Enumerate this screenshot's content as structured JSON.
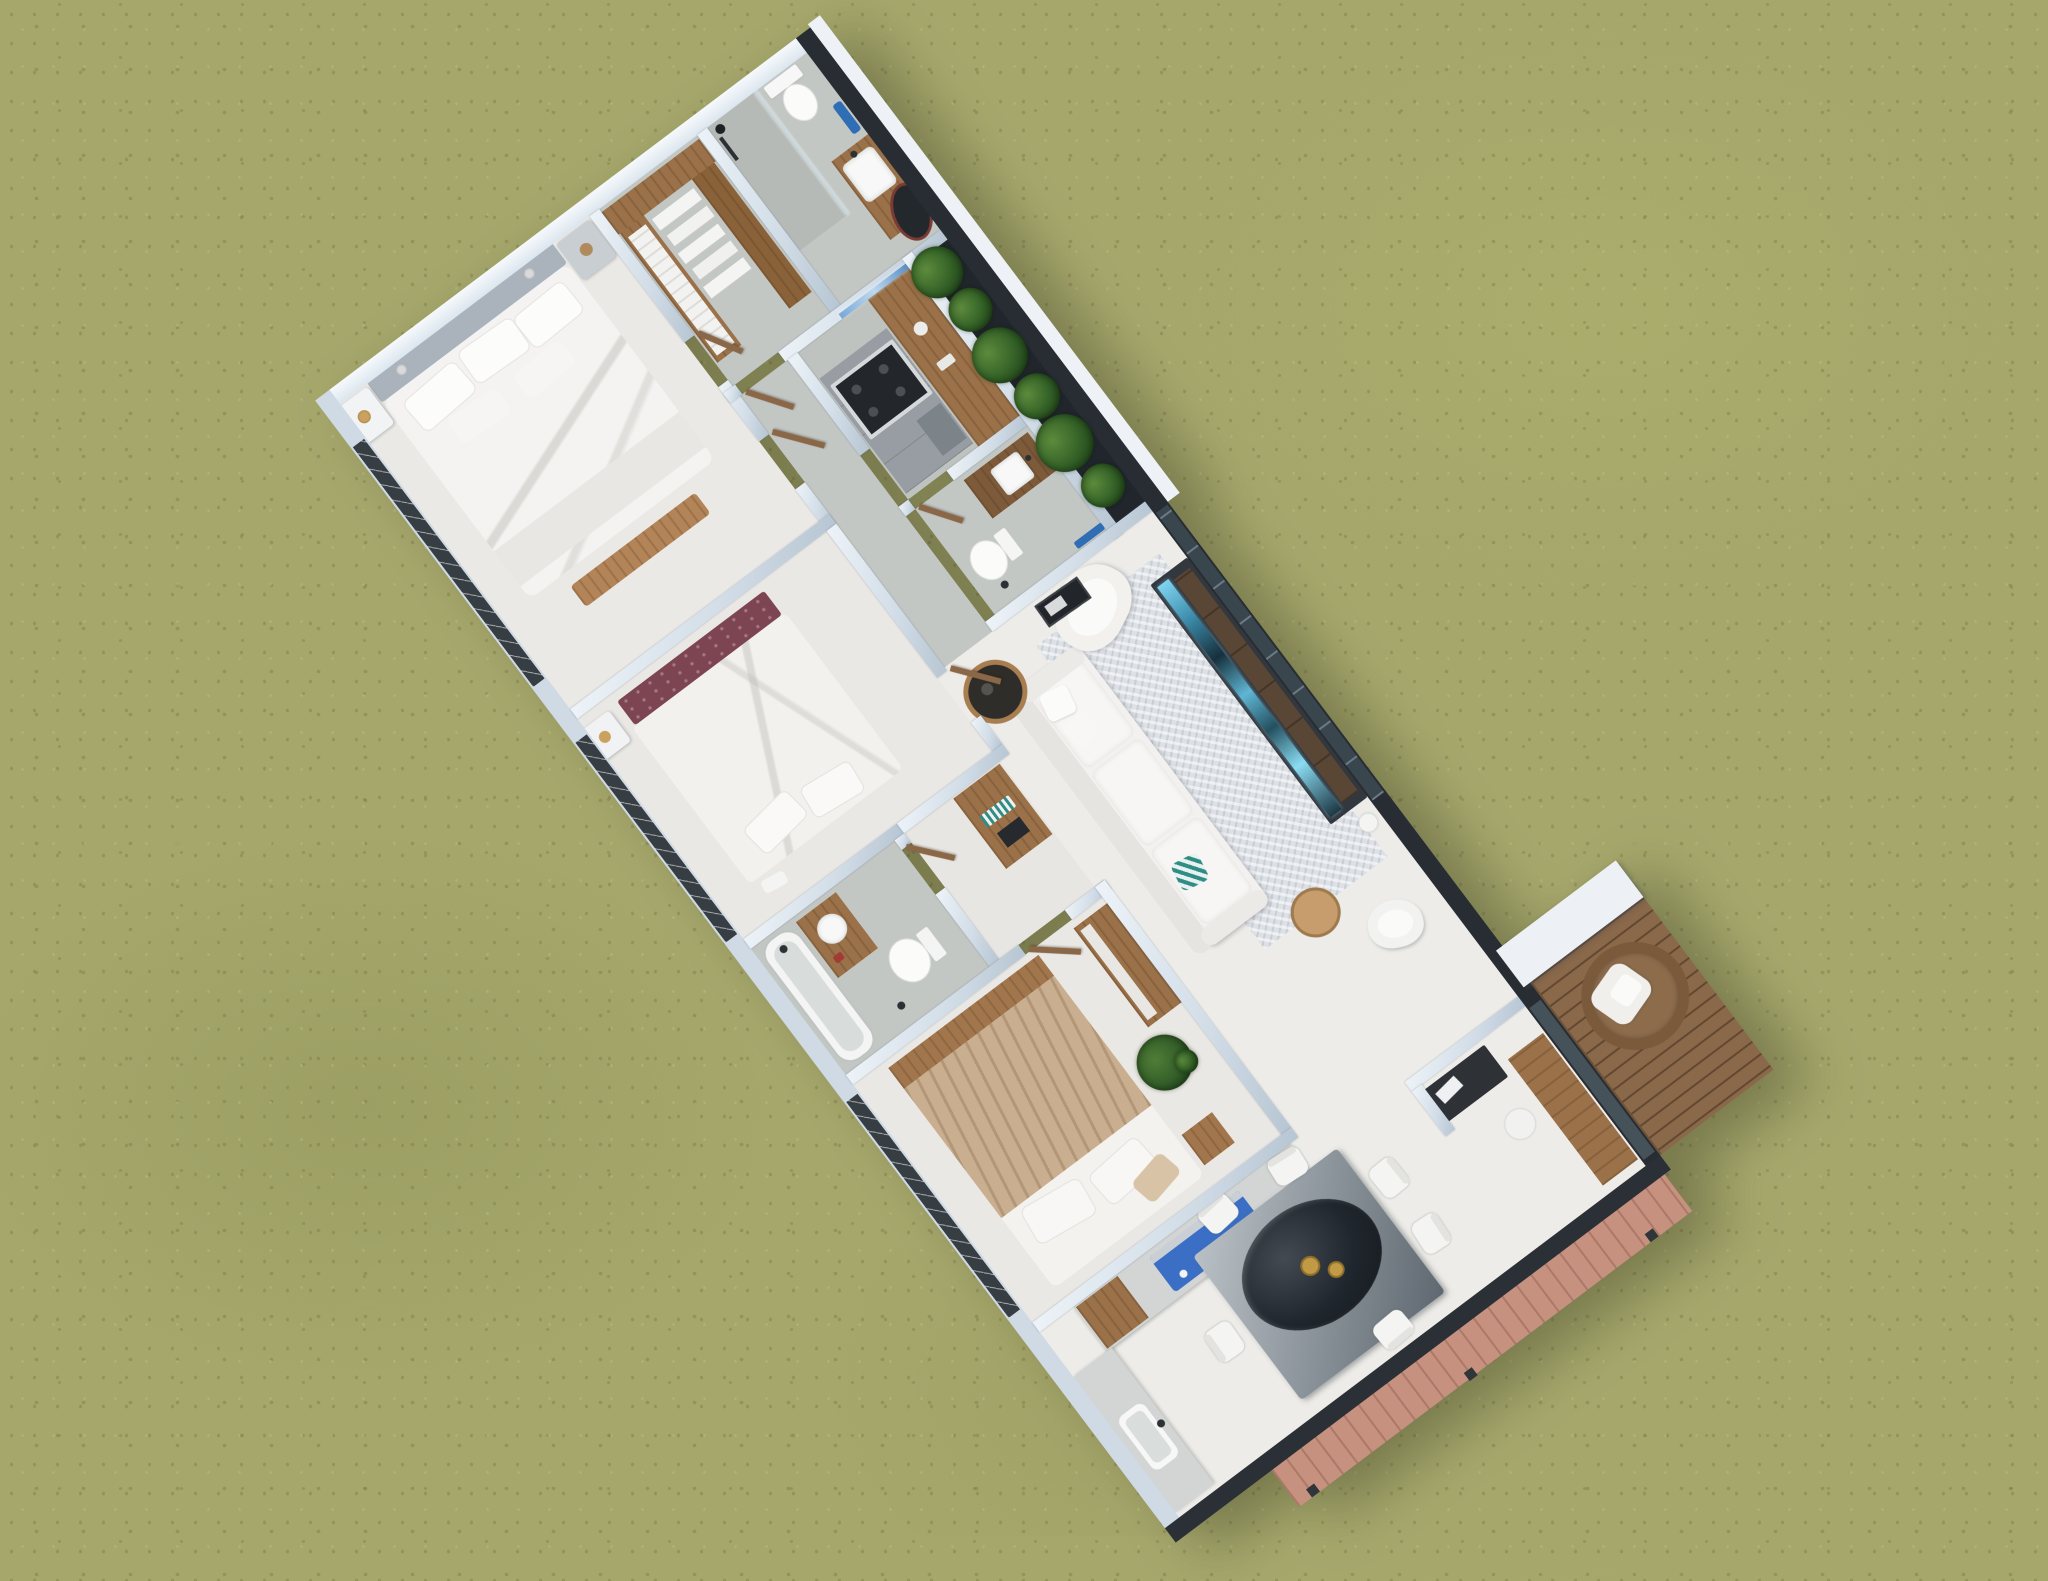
{
  "scene": {
    "type": "3d-floor-plan-aerial-render",
    "view": "top-down dollhouse cutaway of a single-storey house on a grass lawn",
    "house_rotation_deg": -37,
    "no_visible_text": true
  },
  "palette": {
    "grass": "#a5a76b",
    "grass_speckle_dark": "#82854b",
    "grass_speckle_light": "#bdbf7f",
    "wall_top": "#e7eef5",
    "wall_shadow": "#b7c6d3",
    "wall_dark_exterior": "#272d32",
    "floor_white": "#edece8",
    "floor_gray": "#c3c7c4",
    "floor_bedroom": "#eae8e4",
    "wood": "#9a7148",
    "wood_light": "#b28457",
    "maroon_headboard": "#7d4551",
    "tan_blanket": "#c9ae90",
    "cooktop_blue": "#3b6fc6",
    "towel_blue": "#2f6db5",
    "plant_green": "#3c6a2e",
    "deck_wood": "#8a684a",
    "deck_salmon": "#c79180",
    "tv_glow": "#7fd3ef",
    "gold_decor": "#c09a45",
    "white_furniture": "#f2f1ef"
  },
  "rooms": [
    {
      "id": 0,
      "name": "master-bedroom",
      "furniture": [
        "double-bed",
        "two-nightstands",
        "wall-lamps",
        "foot-bench"
      ]
    },
    {
      "id": 1,
      "name": "walk-in-closet",
      "furniture": [
        "l-shaped-wardrobe",
        "folded-clothes-shelves"
      ]
    },
    {
      "id": 2,
      "name": "ensuite-bathroom",
      "furniture": [
        "shower",
        "toilet",
        "vanity-sink",
        "leaning-mirror",
        "blue-towel"
      ]
    },
    {
      "id": 3,
      "name": "hallway",
      "furniture": [
        "wood-doors"
      ]
    },
    {
      "id": 4,
      "name": "kitchen-galley",
      "furniture": [
        "range-cooker",
        "gray-cabinets",
        "walnut-counter-bar"
      ]
    },
    {
      "id": 5,
      "name": "bathroom-two",
      "furniture": [
        "wood-vanity-sink",
        "toilet",
        "framed-art",
        "blue-towel"
      ]
    },
    {
      "id": 6,
      "name": "planter-strip",
      "furniture": [
        "green-shrubs"
      ]
    },
    {
      "id": 7,
      "name": "living-room",
      "furniture": [
        "white-sofa",
        "area-rug",
        "tv-console",
        "armchair",
        "round-side-table",
        "wood-stool",
        "white-lounge-chair"
      ]
    },
    {
      "id": 8,
      "name": "bedroom-two",
      "furniture": [
        "bed-maroon-headboard",
        "white-nightstand",
        "built-in-desk"
      ]
    },
    {
      "id": 9,
      "name": "bathroom-three",
      "furniture": [
        "bathtub",
        "wood-vanity",
        "toilet"
      ]
    },
    {
      "id": 10,
      "name": "bedroom-three",
      "furniture": [
        "bed-wood-headboard",
        "tan-blanket",
        "wood-dresser",
        "potted-plant",
        "side-cube"
      ]
    },
    {
      "id": 11,
      "name": "kitchenette",
      "furniture": [
        "counter-with-blue-cooktop",
        "sink-counter",
        "white-appliance"
      ]
    },
    {
      "id": 12,
      "name": "dining-area",
      "furniture": [
        "glass-top-table",
        "six-white-chairs",
        "gold-bowls"
      ]
    },
    {
      "id": 13,
      "name": "entry",
      "furniture": [
        "dark-console",
        "wood-bench",
        "white-stool"
      ]
    },
    {
      "id": 14,
      "name": "deck",
      "furniture": [
        "wicker-chair-white-cushion",
        "plank-decking"
      ]
    }
  ],
  "counts": {
    "bedrooms": 3,
    "bathrooms": 3,
    "dining_chairs": 6,
    "planter_shrubs": 6
  }
}
